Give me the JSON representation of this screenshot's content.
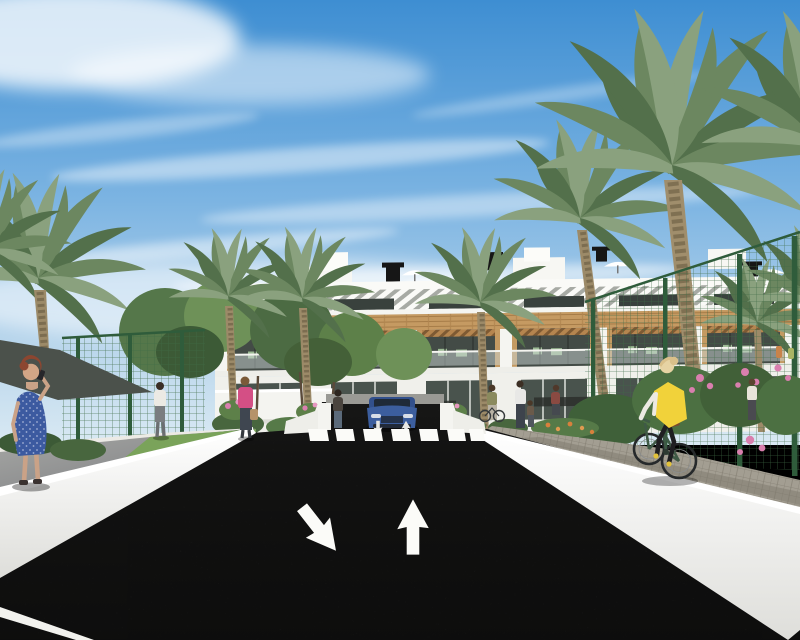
{
  "meta": {
    "type": "architectural-exterior-render",
    "description": "3D visualization of a modern white Mediterranean apartment complex with wood-clad balconies, palm trees, green sports-court fencing, landscaped planters, a dark asphalt street with a zebra crossing, painted lane arrows, a blue car on the garage ramp, pedestrians and a cyclist in a yellow hi-vis vest."
  },
  "palette": {
    "sky_top": "#3e8ed2",
    "sky_mid": "#7cb4e2",
    "sky_horizon": "#d9e9f3",
    "cloud": "#ffffff",
    "building_white": "#f5f5f1",
    "building_shade": "#e3e3de",
    "pergola_base": "#a7aaa4",
    "wood": "#c59a62",
    "wood_dark": "#a67c48",
    "window_dark": "#39413d",
    "balcony_interior": "#434b46",
    "glass": "#ccd6d3",
    "chair_green": "#9cba94",
    "road": "#222221",
    "road_mark": "#fbfbf8",
    "wall_white": "#f4f4f0",
    "wall_edge": "#ffffff",
    "walkway_gray": "#8e8f8d",
    "paver": "#a39e92",
    "paver_dark": "#8b867b",
    "grass": "#7aa35a",
    "tree_green": "#55774a",
    "tree_light": "#6e9158",
    "tree_dark": "#3c5a36",
    "palm_green": "#6c8760",
    "palm_light": "#8aa17e",
    "palm_dark": "#53704b",
    "trunk": "#9c8a68",
    "trunk_dark": "#74654a",
    "fence_green": "#2f5c3b",
    "mesh_green": "#4f7c55",
    "flower_pink": "#d97fae",
    "flower_orange": "#d8803c",
    "canopy_dark": "#4b514b",
    "skin": "#d2a586",
    "hair_auburn": "#8c4630",
    "dress_blue": "#3c5aa0",
    "top_pink": "#d44f85",
    "vest_yellow": "#f1d23a",
    "sleeve_white": "#ece9e2",
    "leggings_black": "#1f1f22",
    "bike_green": "#3f5a46",
    "car_blue": "#3c5e9e",
    "car_glass": "#1f2a38",
    "bin_blue": "#5a7aa8"
  },
  "scene": {
    "sky": {
      "description": "bright blue sky with wispy cirrus cloud streaks and haze near the horizon"
    },
    "building": {
      "description": "three-level white apartment block, slatted roof pergolas, timber cladding band, recessed balconies with glass balustrades and green patio chairs, roof vents and parasols",
      "floors": 3,
      "roof_vents": 4,
      "roof_parasols": 3
    },
    "road": {
      "surface": "dark asphalt",
      "markings": [
        "zebra crossing",
        "down-left lane arrow",
        "up lane arrow",
        "left edge line",
        "small ramp arrows"
      ],
      "crosswalk_stripes": 7
    },
    "vehicles": [
      {
        "type": "car",
        "color": "blue",
        "position": "garage ramp facing street"
      },
      {
        "type": "bicycle",
        "color": "dark green",
        "position": "right footpath"
      }
    ],
    "people": [
      "woman with auburn hair in blue polka-dot dress on phone, left sidewalk",
      "man in white shirt walking away on left path",
      "woman in pink top with handbag walking toward crossing",
      "woman standing by entrance planter",
      "resident with bicycle near entrance",
      "adult with child near entrance",
      "woman in dark red top on terrace",
      "pedestrian in white top far right behind fence",
      "cyclist woman in yellow hi-vis vest on footpath"
    ],
    "vegetation": {
      "palms": 9,
      "deciduous_trees": 5,
      "planting": [
        "pink rose bushes",
        "orange flower bed",
        "clipped hedges",
        "lawn strips"
      ]
    },
    "fences": "dark green mesh sports-court fencing on both sides",
    "structures": [
      "white retaining walls with bright top edges",
      "gray paver footpath right",
      "gray walkway left",
      "dark shade canopy over left court"
    ]
  }
}
